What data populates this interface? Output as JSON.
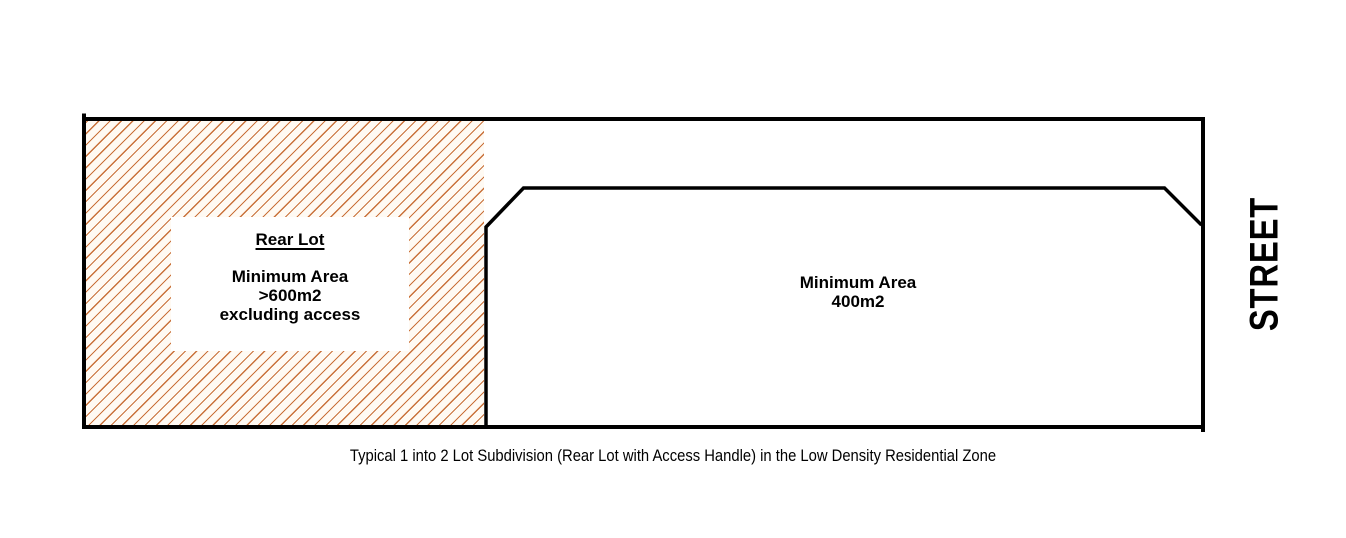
{
  "colors": {
    "hatch": "#c9713a",
    "hatch_bg": "#fffaf3",
    "line": "#000000",
    "background": "#ffffff"
  },
  "diagram": {
    "caption": "Typical 1 into 2 Lot Subdivision (Rear Lot with Access Handle) in the Low Density Residential Zone",
    "street_label": "STREET",
    "rear_lot": {
      "title": "Rear Lot",
      "area_lines": [
        "Minimum Area",
        ">600m2",
        "excluding access"
      ]
    },
    "front_lot": {
      "area_lines": [
        "Minimum Area",
        "400m2"
      ]
    }
  }
}
